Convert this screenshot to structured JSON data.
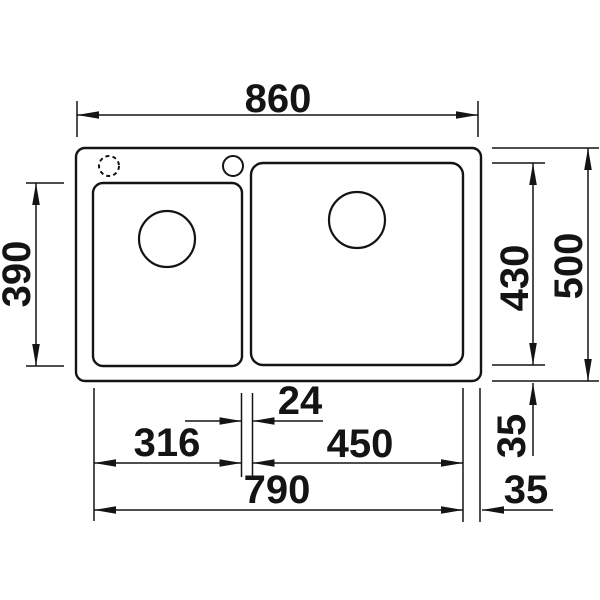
{
  "drawing": {
    "subject": "double-bowl kitchen sink technical drawing, top view with dimensions (mm)",
    "colors": {
      "background": "#ffffff",
      "line": "#141414"
    },
    "dimensions": {
      "overall_width": "860",
      "overall_depth": "500",
      "left_bowl_depth": "390",
      "right_bowl_depth": "430",
      "left_bowl_width": "316",
      "right_bowl_width": "450",
      "divider_width": "24",
      "bowls_outer_width": "790",
      "front_rim": "35",
      "right_rim": "35"
    }
  }
}
